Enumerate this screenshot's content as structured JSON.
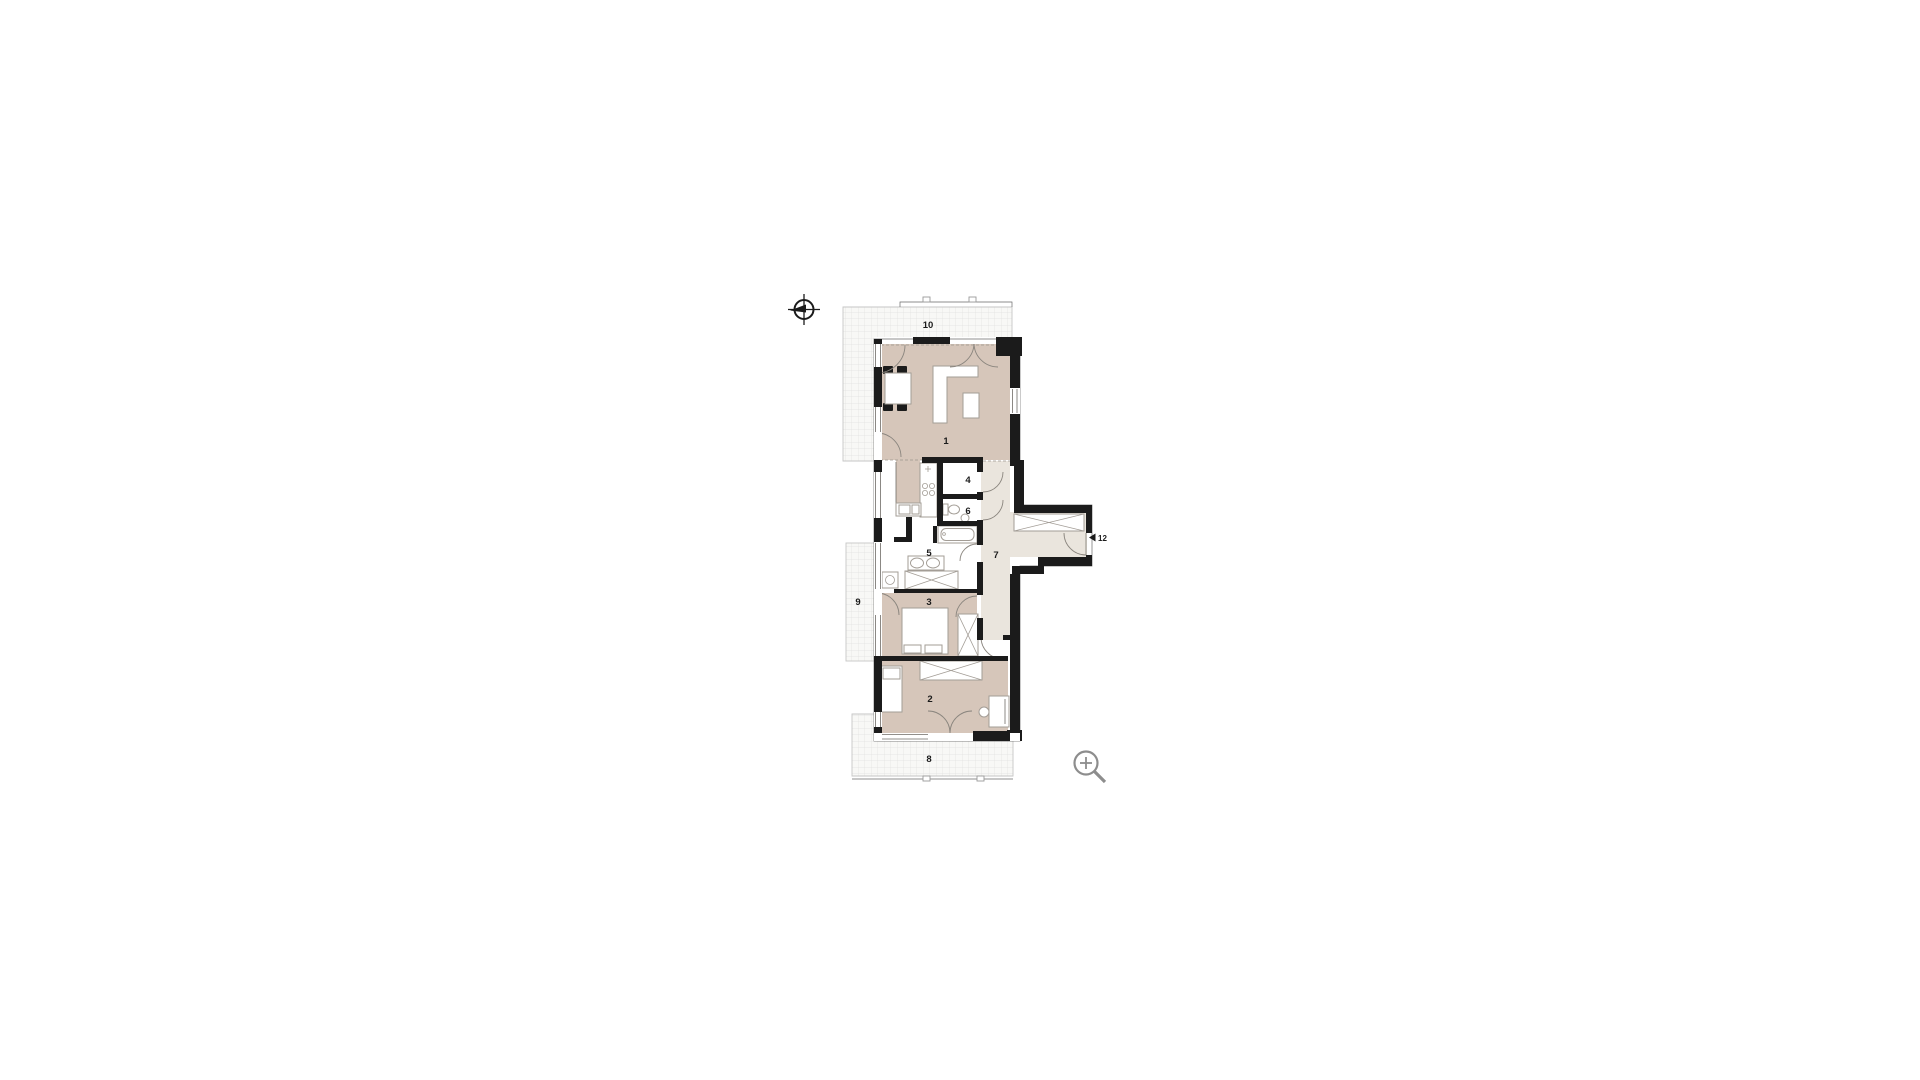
{
  "canvas": {
    "width": 1920,
    "height": 1080,
    "background": "#ffffff"
  },
  "floor_plan": {
    "rooms": [
      {
        "label": "1"
      },
      {
        "label": "2"
      },
      {
        "label": "3"
      },
      {
        "label": "4"
      },
      {
        "label": "5"
      },
      {
        "label": "6"
      },
      {
        "label": "7"
      },
      {
        "label": "8"
      },
      {
        "label": "9"
      },
      {
        "label": "10"
      },
      {
        "label": "12"
      }
    ],
    "colors": {
      "room_fill": "#d6c6ba",
      "corridor_fill": "#eae5dd",
      "terrace_fill": "#f8f8f6",
      "grid_line": "#e0e0e0",
      "wall": "#1b1b1b",
      "door_line": "#8a857e",
      "furniture_stroke": "#a39d96",
      "label_color": "#1b1b1b",
      "icon_gray": "#8d8d8d"
    },
    "icons": [
      {
        "name": "north-arrow-compass"
      },
      {
        "name": "zoom-in-magnifier"
      },
      {
        "name": "entrance-direction-arrow"
      }
    ]
  }
}
